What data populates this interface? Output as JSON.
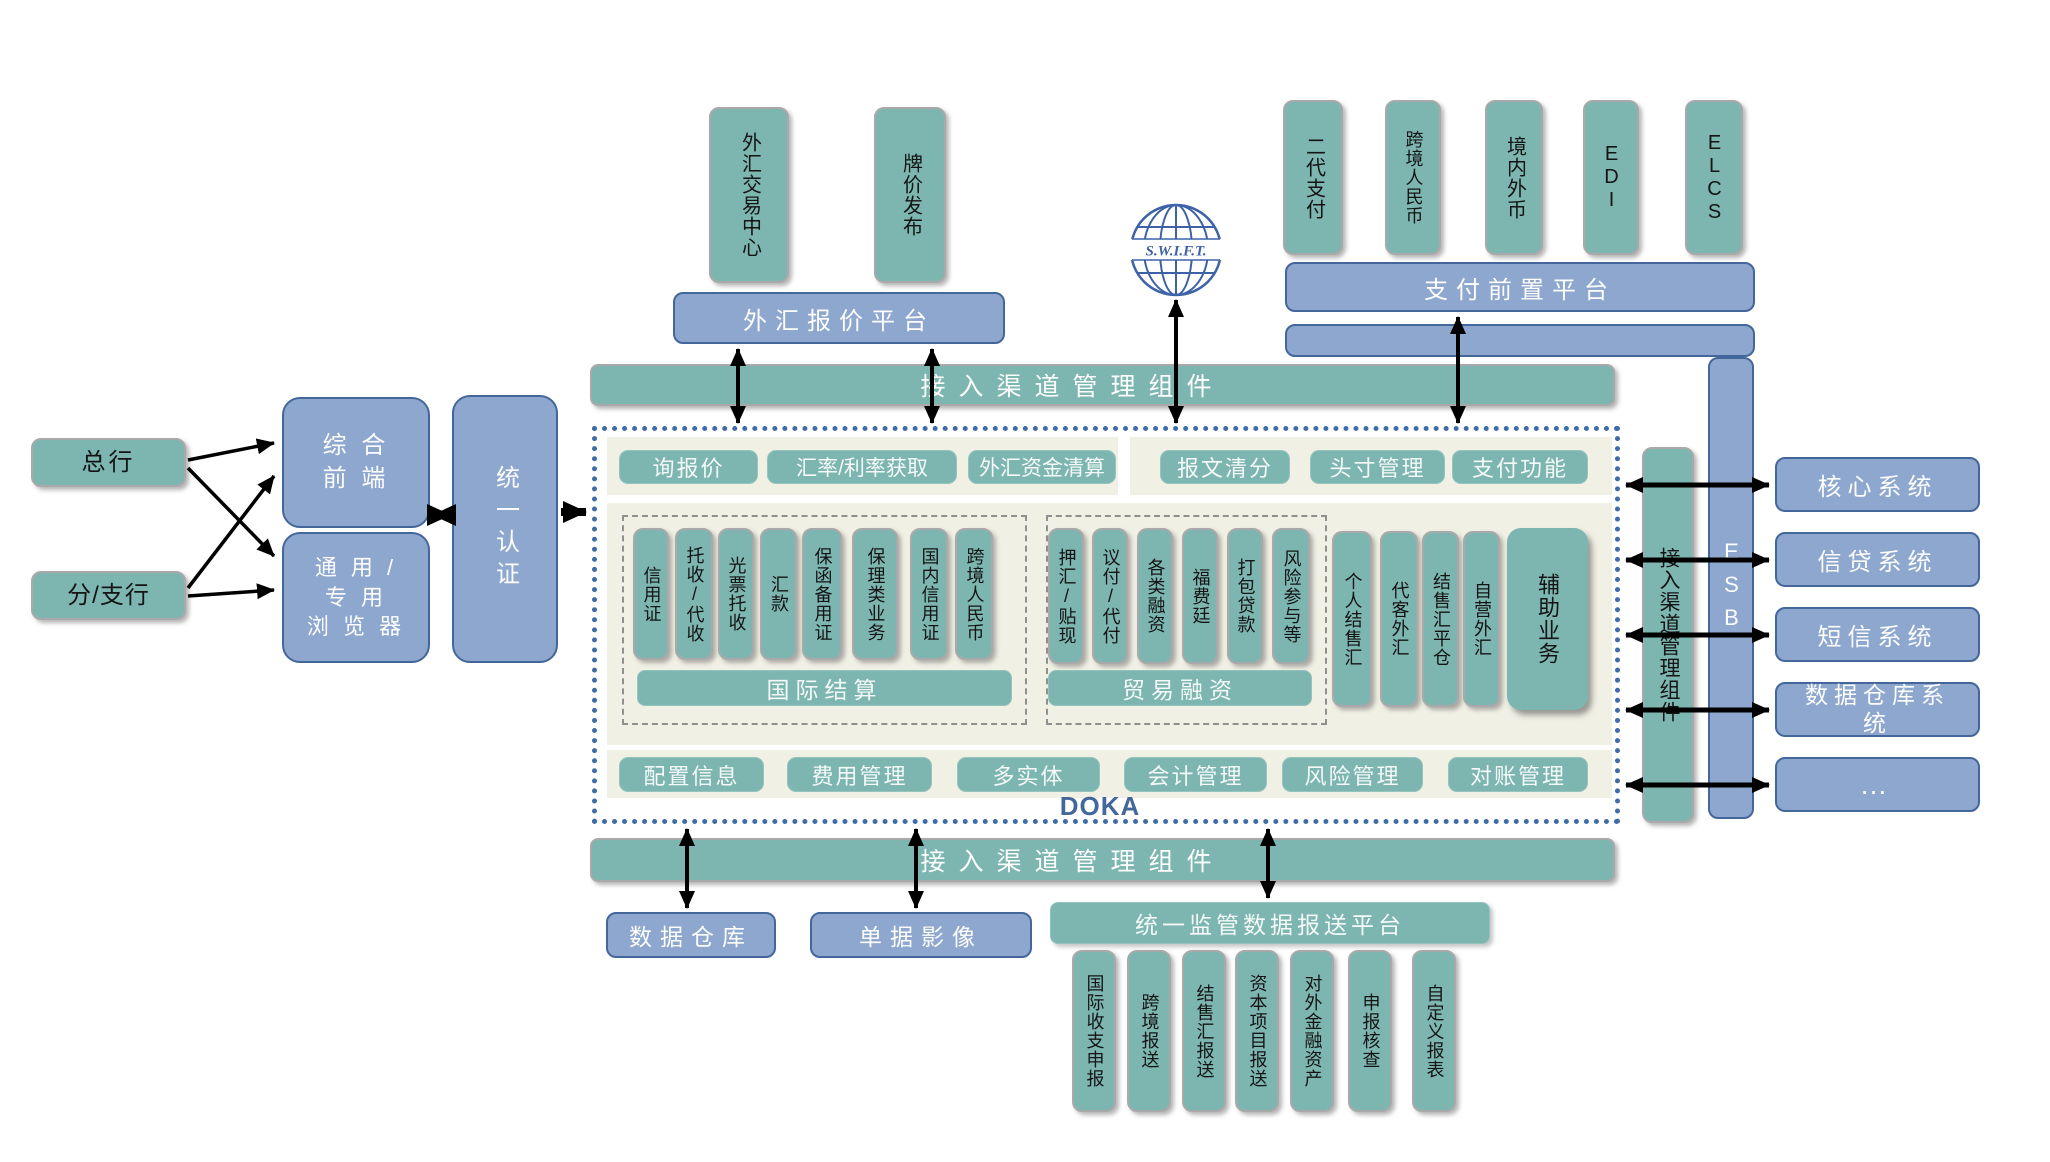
{
  "colors": {
    "teal": "#7db6b1",
    "blue_fill": "#8da7cf",
    "blue_border": "#44679b",
    "cream_panel": "#f0f0e5",
    "dotted_frame": "#3f6ca6",
    "arrow": "#000000",
    "doka_text": "#44679b"
  },
  "top_left": {
    "boxes": [
      "外汇交易中心",
      "牌价发布"
    ],
    "platform": "外汇报价平台"
  },
  "swift": {
    "label": "S.W.I.F.T."
  },
  "top_right": {
    "boxes": [
      "二代支付",
      "跨境人民币",
      "境内外币",
      "EDI",
      "ELCS"
    ],
    "platform": "支付前置平台"
  },
  "left_side": {
    "head_office": "总行",
    "branch": "分/支行",
    "front_end": "综 合\n前 端",
    "browser": "通 用 /\n专 用\n浏 览 器",
    "auth": "统一认证"
  },
  "bars": {
    "top_channel": "接入渠道管理组件",
    "bottom_channel": "接入渠道管理组件",
    "right_channel": "接入渠道管理组件",
    "esb": "ESB"
  },
  "core": {
    "functions_row": [
      "询报价",
      "汇率/利率获取",
      "外汇资金清算",
      "报文清分",
      "头寸管理",
      "支付功能"
    ],
    "intl_settlement": {
      "title": "国际结算",
      "items": [
        "信用证",
        "托收/代收",
        "光票托收",
        "汇款",
        "保函备用证",
        "保理类业务",
        "国内信用证",
        "跨境人民币"
      ]
    },
    "trade_finance": {
      "title": "贸易融资",
      "items": [
        "押汇/贴现",
        "议付/代付",
        "各类融资",
        "福费廷",
        "打包贷款",
        "风险参与等"
      ]
    },
    "fx_boxes": [
      "个人结售汇",
      "代客外汇",
      "结售汇平仓",
      "自营外汇"
    ],
    "aux": "辅助业务",
    "mgmt_row": [
      "配置信息",
      "费用管理",
      "多实体",
      "会计管理",
      "风险管理",
      "对账管理"
    ],
    "brand": "DOKA"
  },
  "right_side": {
    "systems": [
      "核心系统",
      "信贷系统",
      "短信系统",
      "数据仓库系统",
      "…"
    ]
  },
  "bottom": {
    "data_warehouse": "数据仓库",
    "doc_image": "单据影像",
    "regulatory_platform": "统一监管数据报送平台",
    "reports": [
      "国际收支申报",
      "跨境报送",
      "结售汇报送",
      "资本项目报送",
      "对外金融资产",
      "申报核查",
      "自定义报表"
    ]
  }
}
